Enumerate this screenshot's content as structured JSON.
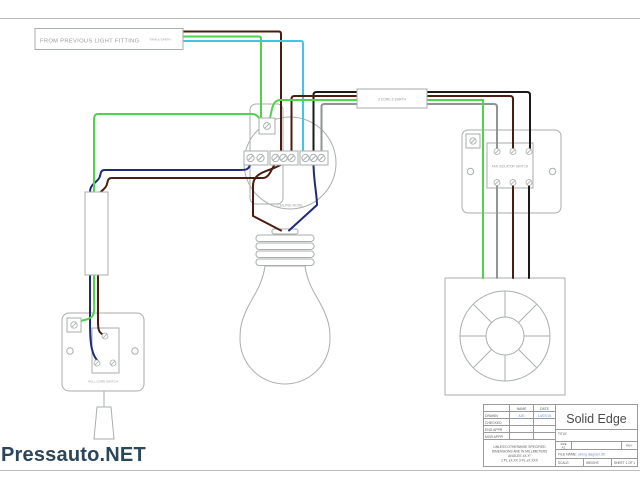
{
  "page": {
    "watermark": "Pressauto.NET"
  },
  "colors": {
    "green": "#4fd348",
    "cyan": "#41c4e6",
    "navy": "#1e2a78",
    "brown": "#4a1d12",
    "black": "#1a1a1a",
    "grey": "#8f9596",
    "outline": "#a9aeae",
    "label": "#9a9a9a",
    "tbline": "#9a9a9a",
    "tbtext": "#5a5a5a",
    "link": "#6a8fd8",
    "watermark": "#2b4559",
    "frame": "#bcbcbc"
  },
  "diagram": {
    "source_label": "FROM PREVIOUS LIGHT FITTING",
    "source_cable": "TWIN & EARTH",
    "fan_cable": "3 CORE & EARTH",
    "ceiling_rose": "CEILING ROSE",
    "isolator": "FAN ISOLATOR SWITCH",
    "switch": "PULL CORD SWITCH"
  },
  "title_block": {
    "brand": "Solid Edge",
    "col_name": "NAME",
    "col_date": "DATE",
    "row_drawn": "DRAWN",
    "drawn_name": "AJE",
    "drawn_date": "14/07/10",
    "row_checked": "CHECKED",
    "row_eng": "ENG APPR",
    "row_mgr": "MGR APPR",
    "note1": "UNLESS OTHERWISE SPECIFIED",
    "note2": "DIMENSIONS ARE IN MILLIMETERS",
    "note3": "ANGLES ±X.X°",
    "note4": "2 PL ±X.XX   3 PL ±X.XXX",
    "title_label": "TITLE",
    "size_label": "SIZE",
    "size": "A2",
    "rev_label": "REV",
    "file_label": "FILE NAME:",
    "file_name": "wiring diagram.dft",
    "scale_label": "SCALE:",
    "weight_label": "WEIGHT:",
    "sheet": "SHEET 1 OF 1"
  }
}
